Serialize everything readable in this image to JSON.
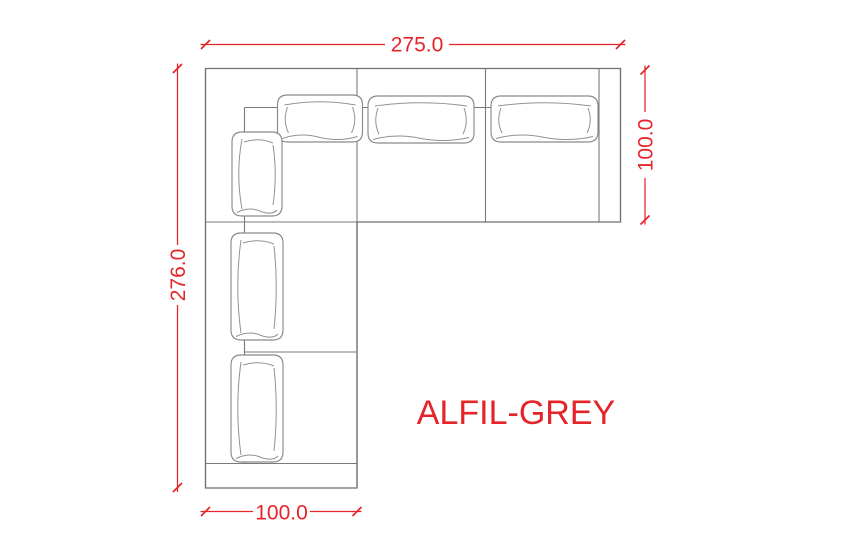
{
  "drawing": {
    "product_name": "ALFIL-GREY",
    "dimensions": {
      "top": "275.0",
      "right": "100.0",
      "left": "276.0",
      "bottom": "100.0"
    },
    "colors": {
      "dimension": "#e5242a",
      "outline_gray": "#6f6f6f",
      "cushion_gray": "#8a8a8a",
      "background": "#ffffff"
    }
  }
}
